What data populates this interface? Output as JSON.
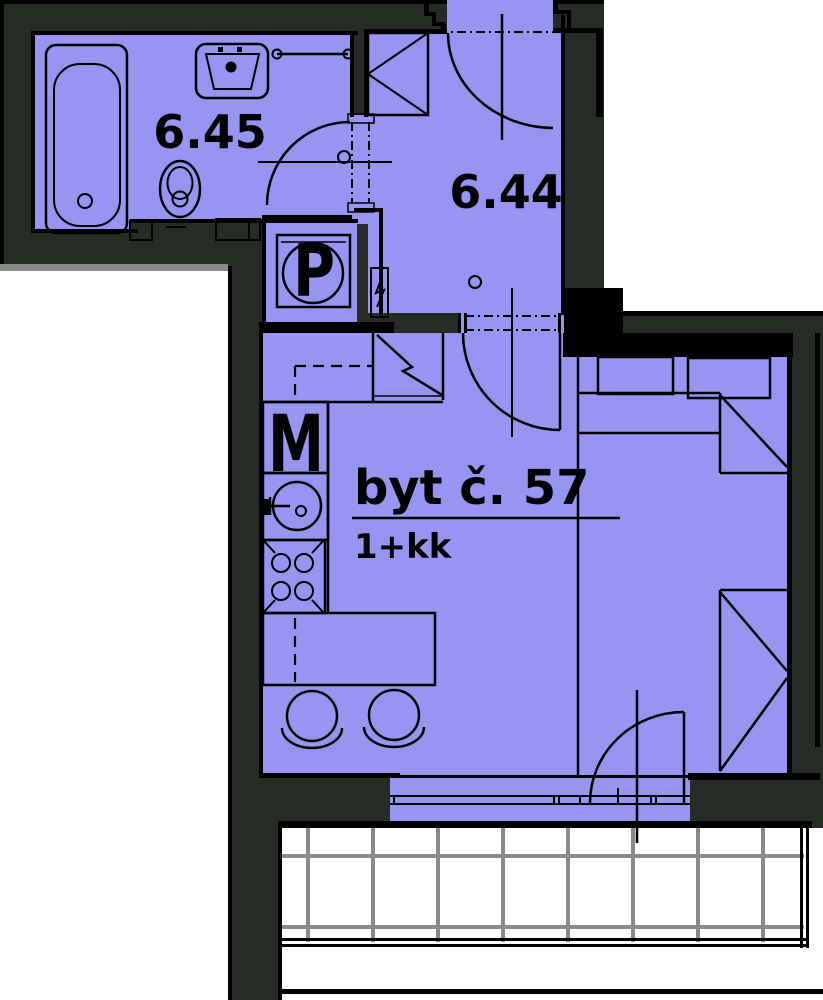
{
  "plan": {
    "apartment": {
      "title": "byt č. 57",
      "layout": "1+kk"
    },
    "room_labels": [
      "6.45",
      "6.44"
    ],
    "appliance_labels": {
      "washing_machine": "P",
      "dishwasher": "M"
    },
    "colors": {
      "floor": "#9794f2",
      "wall": "#272c26",
      "outside": "#ffffff",
      "railing_grid": "#8a8a8a",
      "line": "#000000"
    }
  }
}
